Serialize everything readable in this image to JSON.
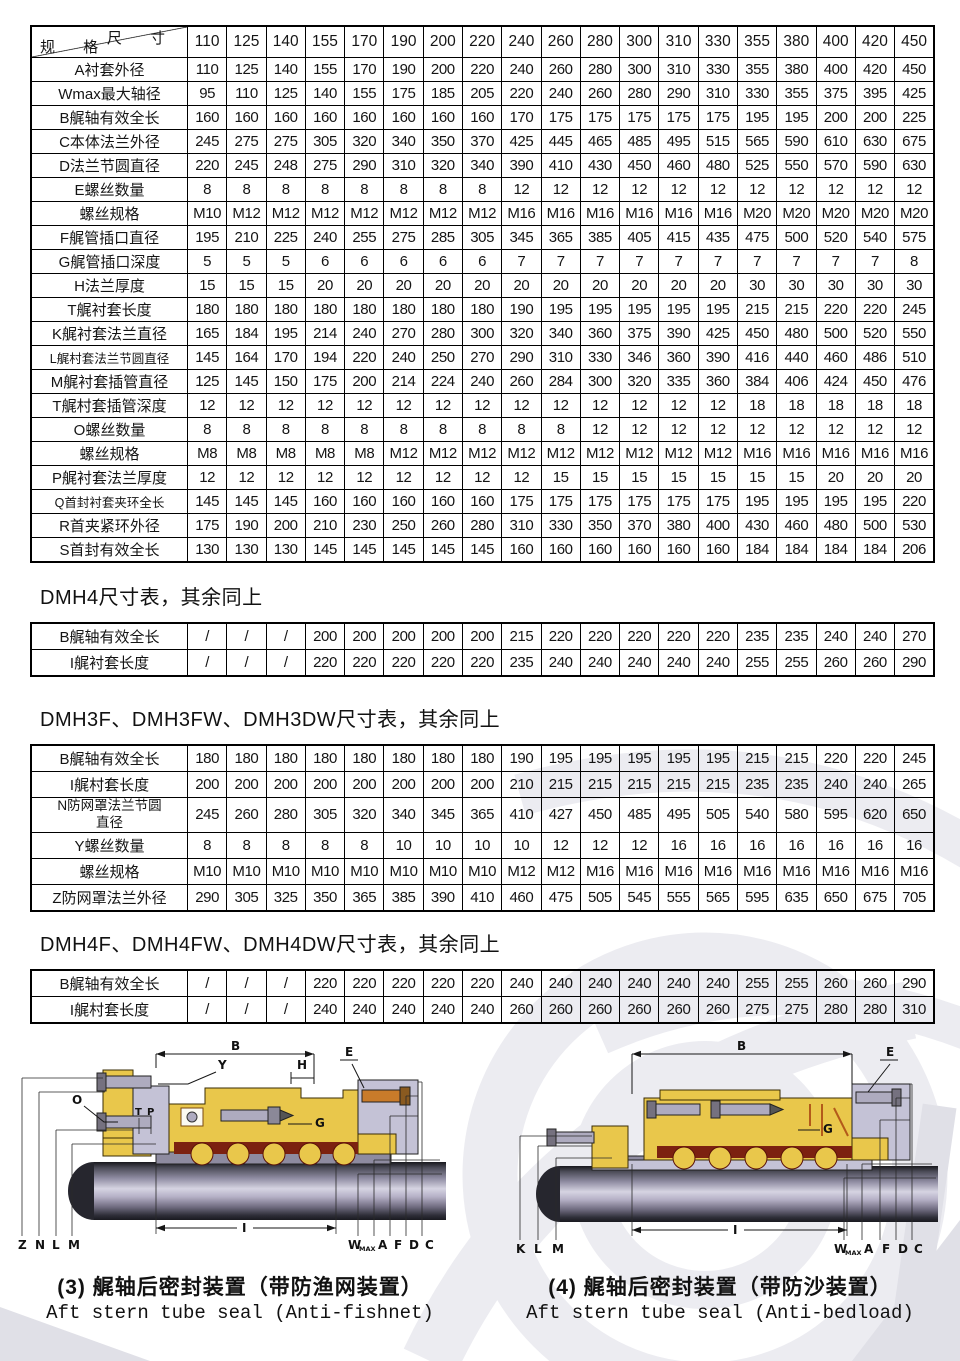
{
  "main_table": {
    "corner": {
      "top": "尺 寸",
      "bottom": "规 格"
    },
    "sizes": [
      "110",
      "125",
      "140",
      "155",
      "170",
      "190",
      "200",
      "220",
      "240",
      "260",
      "280",
      "300",
      "310",
      "330",
      "355",
      "380",
      "400",
      "420",
      "450"
    ],
    "rows": [
      {
        "label": "A衬套外径",
        "values": [
          "110",
          "125",
          "140",
          "155",
          "170",
          "190",
          "200",
          "220",
          "240",
          "260",
          "280",
          "300",
          "310",
          "330",
          "355",
          "380",
          "400",
          "420",
          "450"
        ]
      },
      {
        "label": "Wmax最大轴径",
        "values": [
          "95",
          "110",
          "125",
          "140",
          "155",
          "175",
          "185",
          "205",
          "220",
          "240",
          "260",
          "280",
          "290",
          "310",
          "330",
          "355",
          "375",
          "395",
          "425"
        ]
      },
      {
        "label": "B艉轴有效全长",
        "values": [
          "160",
          "160",
          "160",
          "160",
          "160",
          "160",
          "160",
          "160",
          "170",
          "175",
          "175",
          "175",
          "175",
          "175",
          "195",
          "195",
          "200",
          "200",
          "225"
        ]
      },
      {
        "label": "C本体法兰外径",
        "values": [
          "245",
          "275",
          "275",
          "305",
          "320",
          "340",
          "350",
          "370",
          "425",
          "445",
          "465",
          "485",
          "495",
          "515",
          "565",
          "590",
          "610",
          "630",
          "675"
        ]
      },
      {
        "label": "D法兰节圆直径",
        "values": [
          "220",
          "245",
          "248",
          "275",
          "290",
          "310",
          "320",
          "340",
          "390",
          "410",
          "430",
          "450",
          "460",
          "480",
          "525",
          "550",
          "570",
          "590",
          "630"
        ]
      },
      {
        "label": "E螺丝数量",
        "values": [
          "8",
          "8",
          "8",
          "8",
          "8",
          "8",
          "8",
          "8",
          "12",
          "12",
          "12",
          "12",
          "12",
          "12",
          "12",
          "12",
          "12",
          "12",
          "12"
        ]
      },
      {
        "label": "螺丝规格",
        "values": [
          "M10",
          "M12",
          "M12",
          "M12",
          "M12",
          "M12",
          "M12",
          "M12",
          "M16",
          "M16",
          "M16",
          "M16",
          "M16",
          "M16",
          "M20",
          "M20",
          "M20",
          "M20",
          "M20"
        ]
      },
      {
        "label": "F艉管插口直径",
        "values": [
          "195",
          "210",
          "225",
          "240",
          "255",
          "275",
          "285",
          "305",
          "345",
          "365",
          "385",
          "405",
          "415",
          "435",
          "475",
          "500",
          "520",
          "540",
          "575"
        ]
      },
      {
        "label": "G艉管插口深度",
        "values": [
          "5",
          "5",
          "5",
          "6",
          "6",
          "6",
          "6",
          "6",
          "7",
          "7",
          "7",
          "7",
          "7",
          "7",
          "7",
          "7",
          "7",
          "7",
          "8"
        ]
      },
      {
        "label": "H法兰厚度",
        "values": [
          "15",
          "15",
          "15",
          "20",
          "20",
          "20",
          "20",
          "20",
          "20",
          "20",
          "20",
          "20",
          "20",
          "20",
          "30",
          "30",
          "30",
          "30",
          "30"
        ]
      },
      {
        "label": "T艉衬套长度",
        "values": [
          "180",
          "180",
          "180",
          "180",
          "180",
          "180",
          "180",
          "180",
          "190",
          "195",
          "195",
          "195",
          "195",
          "195",
          "215",
          "215",
          "220",
          "220",
          "245"
        ]
      },
      {
        "label": "K艉衬套法兰直径",
        "values": [
          "165",
          "184",
          "195",
          "214",
          "240",
          "270",
          "280",
          "300",
          "320",
          "340",
          "360",
          "375",
          "390",
          "425",
          "450",
          "480",
          "500",
          "520",
          "550"
        ]
      },
      {
        "label": "L艉村套法兰节圆直径",
        "values": [
          "145",
          "164",
          "170",
          "194",
          "220",
          "240",
          "250",
          "270",
          "290",
          "310",
          "330",
          "346",
          "360",
          "390",
          "416",
          "440",
          "460",
          "486",
          "510"
        ]
      },
      {
        "label": "M艉衬套插管直径",
        "values": [
          "125",
          "145",
          "150",
          "175",
          "200",
          "214",
          "224",
          "240",
          "260",
          "284",
          "300",
          "320",
          "335",
          "360",
          "384",
          "406",
          "424",
          "450",
          "476"
        ]
      },
      {
        "label": "T艉村套插管深度",
        "values": [
          "12",
          "12",
          "12",
          "12",
          "12",
          "12",
          "12",
          "12",
          "12",
          "12",
          "12",
          "12",
          "12",
          "12",
          "18",
          "18",
          "18",
          "18",
          "18"
        ]
      },
      {
        "label": "O螺丝数量",
        "values": [
          "8",
          "8",
          "8",
          "8",
          "8",
          "8",
          "8",
          "8",
          "8",
          "8",
          "12",
          "12",
          "12",
          "12",
          "12",
          "12",
          "12",
          "12",
          "12"
        ]
      },
      {
        "label": "螺丝规格",
        "values": [
          "M8",
          "M8",
          "M8",
          "M8",
          "M8",
          "M12",
          "M12",
          "M12",
          "M12",
          "M12",
          "M12",
          "M12",
          "M12",
          "M12",
          "M16",
          "M16",
          "M16",
          "M16",
          "M16"
        ]
      },
      {
        "label": "P艉衬套法兰厚度",
        "values": [
          "12",
          "12",
          "12",
          "12",
          "12",
          "12",
          "12",
          "12",
          "12",
          "15",
          "15",
          "15",
          "15",
          "15",
          "15",
          "15",
          "20",
          "20",
          "20"
        ]
      },
      {
        "label": "Q首封衬套夹环全长",
        "values": [
          "145",
          "145",
          "145",
          "160",
          "160",
          "160",
          "160",
          "160",
          "175",
          "175",
          "175",
          "175",
          "175",
          "175",
          "195",
          "195",
          "195",
          "195",
          "220"
        ]
      },
      {
        "label": "R首夹紧环外径",
        "values": [
          "175",
          "190",
          "200",
          "210",
          "230",
          "250",
          "260",
          "280",
          "310",
          "330",
          "350",
          "370",
          "380",
          "400",
          "430",
          "460",
          "480",
          "500",
          "530"
        ]
      },
      {
        "label": "S首封有效全长",
        "values": [
          "130",
          "130",
          "130",
          "145",
          "145",
          "145",
          "145",
          "145",
          "160",
          "160",
          "160",
          "160",
          "160",
          "160",
          "184",
          "184",
          "184",
          "184",
          "206"
        ]
      }
    ]
  },
  "sections": {
    "dmh4": {
      "heading": "DMH4尺寸表，其余同上",
      "table": {
        "rows": [
          {
            "label": "B艉轴有效全长",
            "values": [
              "/",
              "/",
              "/",
              "200",
              "200",
              "200",
              "200",
              "200",
              "215",
              "220",
              "220",
              "220",
              "220",
              "220",
              "235",
              "235",
              "240",
              "240",
              "270"
            ]
          },
          {
            "label": "I艉衬套长度",
            "values": [
              "/",
              "/",
              "/",
              "220",
              "220",
              "220",
              "220",
              "220",
              "235",
              "240",
              "240",
              "240",
              "240",
              "240",
              "255",
              "255",
              "260",
              "260",
              "290"
            ]
          }
        ]
      }
    },
    "dmh3f": {
      "heading": "DMH3F、DMH3FW、DMH3DW尺寸表，其余同上",
      "table": {
        "rows": [
          {
            "label": "B艉轴有效全长",
            "values": [
              "180",
              "180",
              "180",
              "180",
              "180",
              "180",
              "180",
              "180",
              "190",
              "195",
              "195",
              "195",
              "195",
              "195",
              "215",
              "215",
              "220",
              "220",
              "245"
            ]
          },
          {
            "label": "I艉村套长度",
            "values": [
              "200",
              "200",
              "200",
              "200",
              "200",
              "200",
              "200",
              "200",
              "210",
              "215",
              "215",
              "215",
              "215",
              "215",
              "235",
              "235",
              "240",
              "240",
              "265"
            ]
          },
          {
            "label": "N防网罩法兰节圆\n直径",
            "values": [
              "245",
              "260",
              "280",
              "305",
              "320",
              "340",
              "345",
              "365",
              "410",
              "427",
              "450",
              "485",
              "495",
              "505",
              "540",
              "580",
              "595",
              "620",
              "650"
            ]
          },
          {
            "label": "Y螺丝数量",
            "values": [
              "8",
              "8",
              "8",
              "8",
              "8",
              "10",
              "10",
              "10",
              "10",
              "12",
              "12",
              "12",
              "16",
              "16",
              "16",
              "16",
              "16",
              "16",
              "16"
            ]
          },
          {
            "label": "螺丝规格",
            "values": [
              "M10",
              "M10",
              "M10",
              "M10",
              "M10",
              "M10",
              "M10",
              "M10",
              "M12",
              "M12",
              "M16",
              "M16",
              "M16",
              "M16",
              "M16",
              "M16",
              "M16",
              "M16",
              "M16"
            ]
          },
          {
            "label": "Z防网罩法兰外径",
            "values": [
              "290",
              "305",
              "325",
              "350",
              "365",
              "385",
              "390",
              "410",
              "460",
              "475",
              "505",
              "545",
              "555",
              "565",
              "595",
              "635",
              "650",
              "675",
              "705"
            ]
          }
        ]
      }
    },
    "dmh4f": {
      "heading": "DMH4F、DMH4FW、DMH4DW尺寸表，其余同上",
      "table": {
        "rows": [
          {
            "label": "B艉轴有效全长",
            "values": [
              "/",
              "/",
              "/",
              "220",
              "220",
              "220",
              "220",
              "220",
              "240",
              "240",
              "240",
              "240",
              "240",
              "240",
              "255",
              "255",
              "260",
              "260",
              "290"
            ]
          },
          {
            "label": "I艉村套长度",
            "values": [
              "/",
              "/",
              "/",
              "240",
              "240",
              "240",
              "240",
              "240",
              "260",
              "260",
              "260",
              "260",
              "260",
              "260",
              "275",
              "275",
              "280",
              "280",
              "310"
            ]
          }
        ]
      }
    }
  },
  "diagrams": [
    {
      "caption_zh": "(3) 艉轴后密封装置（带防渔网装置）",
      "caption_en": "Aft stern tube seal (Anti-fishnet)",
      "labels": {
        "b": "B",
        "y": "Y",
        "h": "H",
        "e": "E",
        "o": "O",
        "t": "T",
        "p": "P",
        "g": "G",
        "i": "I",
        "w": "W",
        "w_sub": "MAX",
        "left": [
          "Z",
          "N",
          "L",
          "M"
        ],
        "right": [
          "A",
          "F",
          "D",
          "C"
        ]
      }
    },
    {
      "caption_zh": "(4) 艉轴后密封装置（带防沙装置）",
      "caption_en": "Aft stern tube seal (Anti-bedload)",
      "labels": {
        "b": "B",
        "e": "E",
        "g": "G",
        "i": "I",
        "w": "W",
        "w_sub": "MAX",
        "left": [
          "K",
          "L",
          "M"
        ],
        "right": [
          "A",
          "F",
          "D",
          "C"
        ]
      }
    }
  ],
  "colors": {
    "body_yellow": "#e9c74b",
    "flange_gray": "#c4c2d6",
    "seal_maroon": "#7c2110",
    "bolt_gray": "#aeabbf",
    "accent_orange": "#c97b2a",
    "shaft_light": "#d6d4e2",
    "shaft_dark": "#17171d",
    "watermark_gray": "#ebebef",
    "text": "#1a1a1a"
  }
}
